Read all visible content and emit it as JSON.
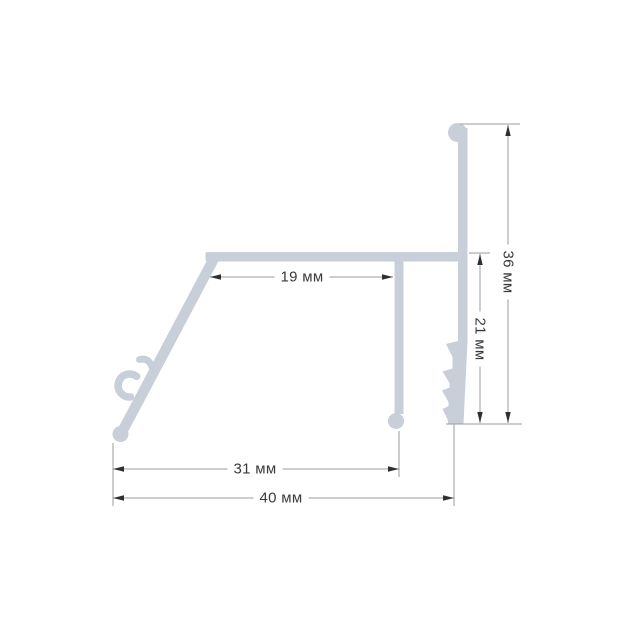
{
  "drawing": {
    "type": "technical-cross-section",
    "subject": "aluminum-profile",
    "unit_suffix": "мм",
    "dimensions": {
      "inner_top_width": {
        "label": "19 мм",
        "value": 19
      },
      "middle_width": {
        "label": "31 мм",
        "value": 31
      },
      "overall_width": {
        "label": "40 мм",
        "value": 40
      },
      "inner_right_height": {
        "label": "21 мм",
        "value": 21
      },
      "overall_height": {
        "label": "36 мм",
        "value": 36
      }
    },
    "colors": {
      "profile_fill": "#c9cfd8",
      "dimension_line": "#9b9b9b",
      "arrowhead": "#2f2f2f",
      "label_text": "#3a3a3a",
      "background": "#ffffff"
    }
  }
}
